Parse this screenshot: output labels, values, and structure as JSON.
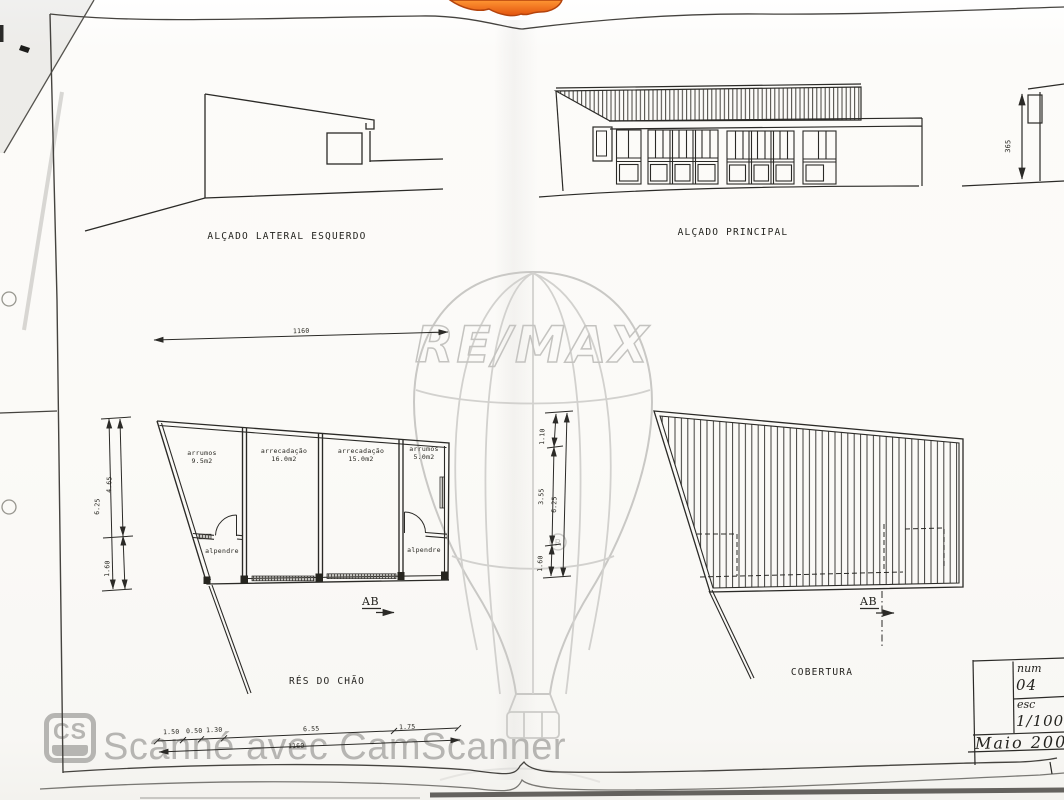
{
  "document": {
    "drawings": {
      "elevation_left": {
        "title": "ALÇADO LATERAL ESQUERDO"
      },
      "elevation_main": {
        "title": "ALÇADO PRINCIPAL"
      },
      "floor_plan": {
        "title": "RÉS DO CHÃO",
        "section_marker": "AB",
        "rooms": [
          {
            "name": "arrumos",
            "area": "9.5m2"
          },
          {
            "name": "arrecadação",
            "area": "16.0m2"
          },
          {
            "name": "arrecadação",
            "area": "15.0m2"
          },
          {
            "name": "arrumos",
            "area": "5.0m2"
          }
        ],
        "porches": [
          "alpendre",
          "alpendre"
        ]
      },
      "roof_plan": {
        "title": "COBERTURA",
        "section_marker": "AB"
      }
    },
    "dimensions": {
      "plan_width_top": "1160",
      "plan_left_total": "6.25",
      "plan_left_upper": "4.65",
      "plan_left_lower": "1.60",
      "mid_upper": "1.10",
      "mid_middle": "3.55",
      "mid_total": "6.25",
      "mid_lower": "1.60",
      "elevation_height": "365",
      "bottom_seg_1": "1.50",
      "bottom_seg_2": "0.50",
      "bottom_seg_3": "1.30",
      "bottom_seg_4": "6.55",
      "bottom_seg_5": "1.75",
      "bottom_total": "1160"
    },
    "title_block": {
      "num_label": "num",
      "num_value": "04",
      "esc_label": "esc",
      "esc_value": "1/100",
      "date": "Maio 2003"
    },
    "watermarks": {
      "remax": "RE/MAX",
      "camscanner": "Scanné avec CamScanner",
      "cs_logo": "CS"
    }
  }
}
